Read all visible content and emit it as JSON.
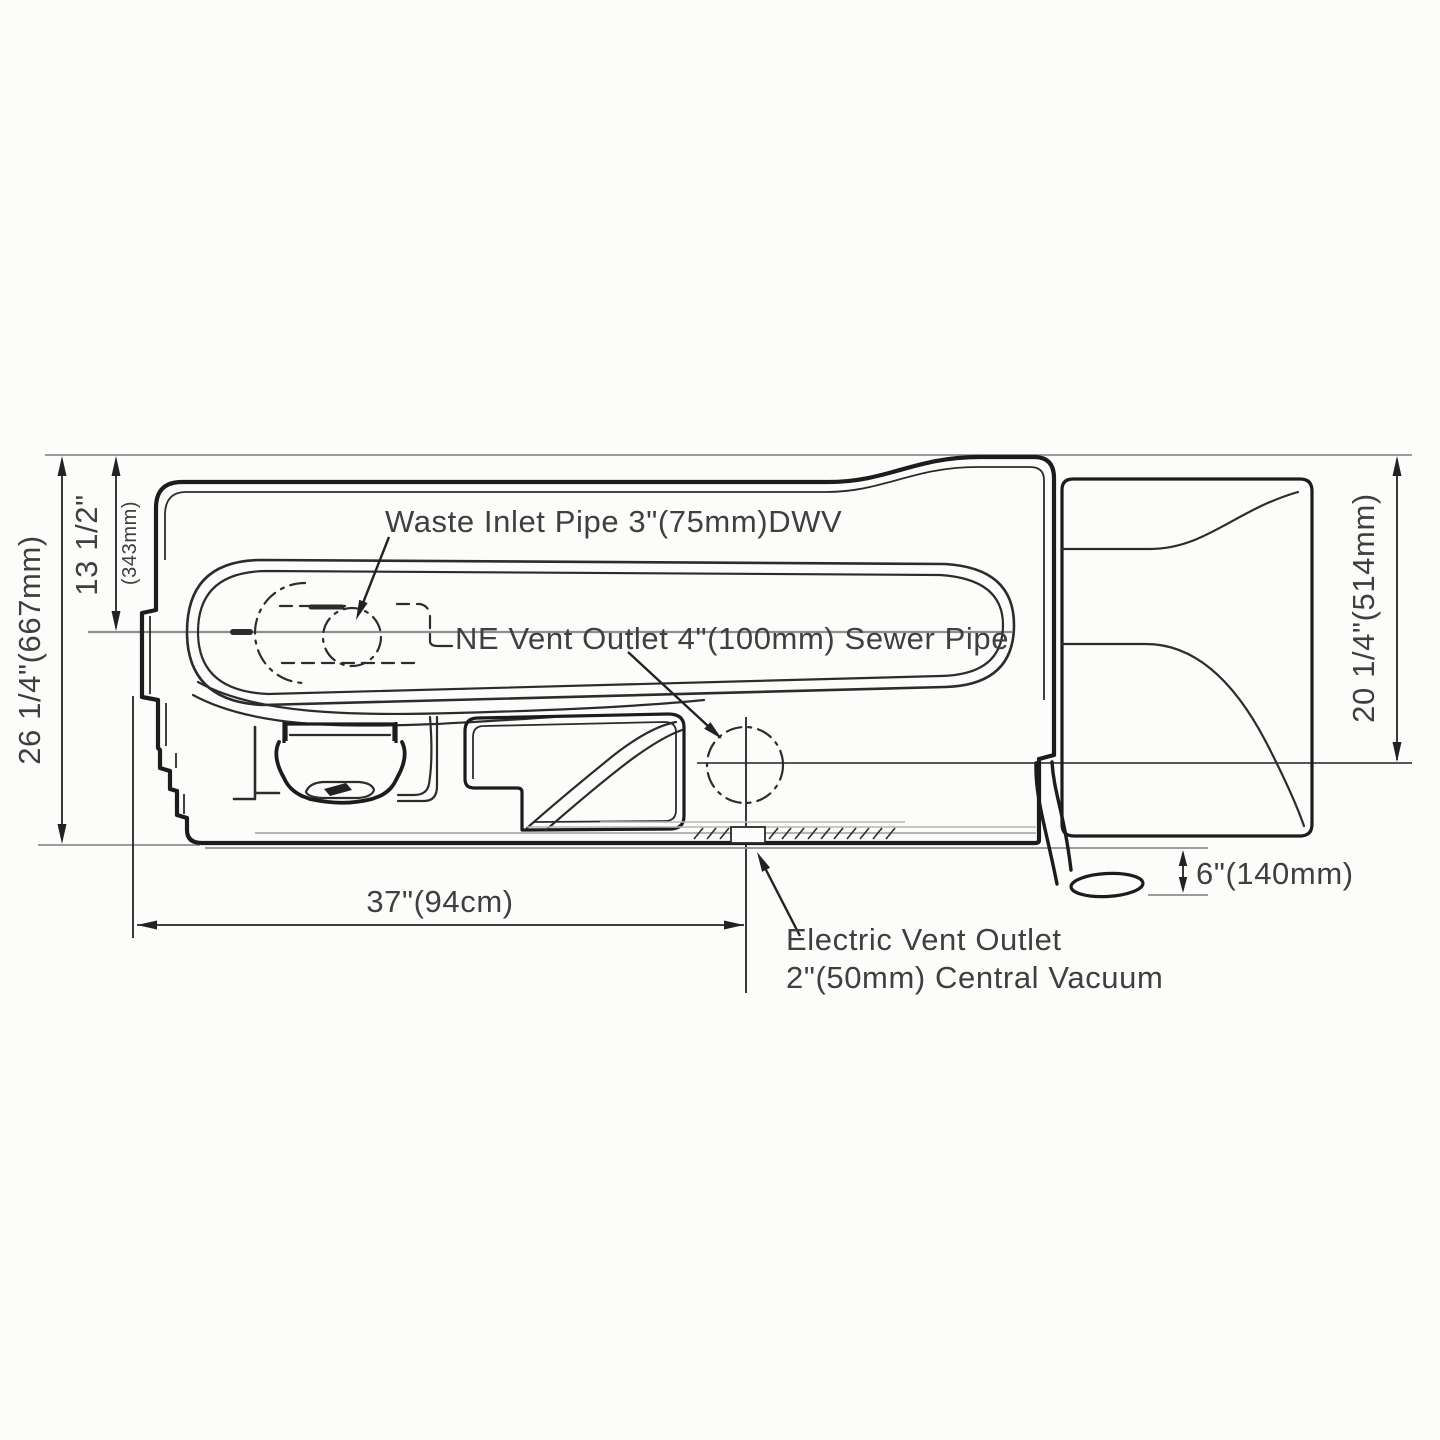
{
  "figure": {
    "type": "technical-drawing-top-view",
    "subject": "waste tank with vent and vacuum outlets",
    "colors": {
      "bg": "#fcfcfa",
      "ink": "#1c1c1c",
      "text": "#3f3f3f",
      "gray_line": "#8f8f8f"
    }
  },
  "callouts": {
    "waste_inlet": "Waste Inlet Pipe 3\"(75mm)DWV",
    "ne_vent": "NE Vent Outlet 4\"(100mm) Sewer Pipe",
    "electric_vent_line1": "Electric Vent Outlet",
    "electric_vent_line2": "2\"(50mm) Central Vacuum"
  },
  "dimensions": {
    "overall_height": "26 1/4\"(667mm)",
    "inlet_centerline_height_in": "13 1/2\"",
    "inlet_centerline_height_mm": "(343mm)",
    "discharge_side_height": "20 1/4\"(514mm)",
    "tank_width": "37\"(94cm)",
    "hose_drop": "6\"(140mm)"
  }
}
